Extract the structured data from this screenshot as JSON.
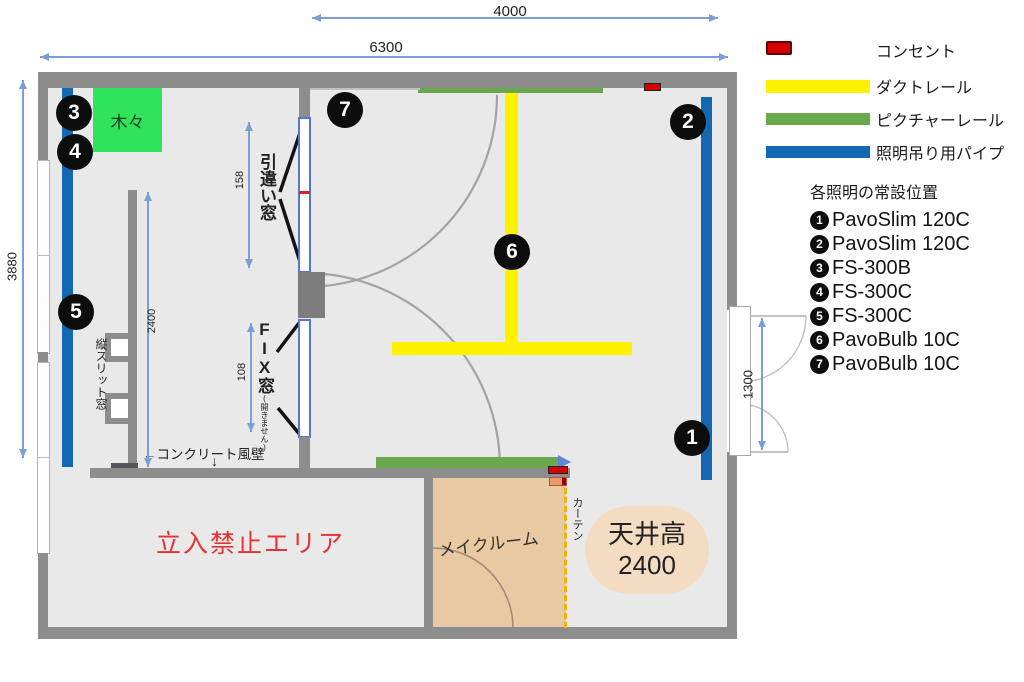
{
  "dimensions": {
    "top_width": "4000",
    "full_width": "6300",
    "left_height": "3880",
    "sliding_window_height": "158",
    "fix_window_height": "108",
    "concrete_wall_length": "2400",
    "door_width": "1300"
  },
  "plan": {
    "trees_label": "木々",
    "sliding_window_label": "引違い窓",
    "fix_window_label": "FIX窓",
    "fix_window_note": "(開きません)",
    "slit_window_label": "縦スリット窓",
    "concrete_wall_label": "←コンクリート風壁",
    "concrete_wall_arrow": "↓",
    "no_entry_label": "立入禁止エリア",
    "makeup_room_label": "メイクルーム",
    "curtain_label": "カーテン",
    "ceiling_title": "天井高",
    "ceiling_value": "2400",
    "markers": [
      "1",
      "2",
      "3",
      "4",
      "5",
      "6",
      "7"
    ]
  },
  "legend": {
    "items": [
      {
        "swatch": "outlet",
        "label": "コンセント"
      },
      {
        "swatch": "duct-rail",
        "label": "ダクトレール"
      },
      {
        "swatch": "picture-rail",
        "label": "ピクチャーレール"
      },
      {
        "swatch": "lighting-pipe",
        "label": "照明吊り用パイプ"
      }
    ],
    "heading": "各照明の常設位置",
    "lights": [
      {
        "num": "1",
        "label": "PavoSlim 120C"
      },
      {
        "num": "2",
        "label": "PavoSlim 120C"
      },
      {
        "num": "3",
        "label": "FS-300B"
      },
      {
        "num": "4",
        "label": "FS-300C"
      },
      {
        "num": "5",
        "label": "FS-300C"
      },
      {
        "num": "6",
        "label": "PavoBulb 10C"
      },
      {
        "num": "7",
        "label": "PavoBulb 10C"
      }
    ]
  },
  "colors": {
    "wall": "#8d8d8d",
    "interior": "#e9e9e9",
    "duct_rail_yellow": "#fff100",
    "picture_rail_green": "#6aa84f",
    "lighting_pipe_blue": "#1467b1",
    "outlet_red": "#d40000",
    "trees_green": "#2fe35b",
    "makeup_tan": "#e9c9a1",
    "ceiling_pill": "#f3dcc2",
    "no_entry_red": "#e63232",
    "curtain_yellow": "#f0b400",
    "dimension_blue": "#7b9fd6"
  }
}
